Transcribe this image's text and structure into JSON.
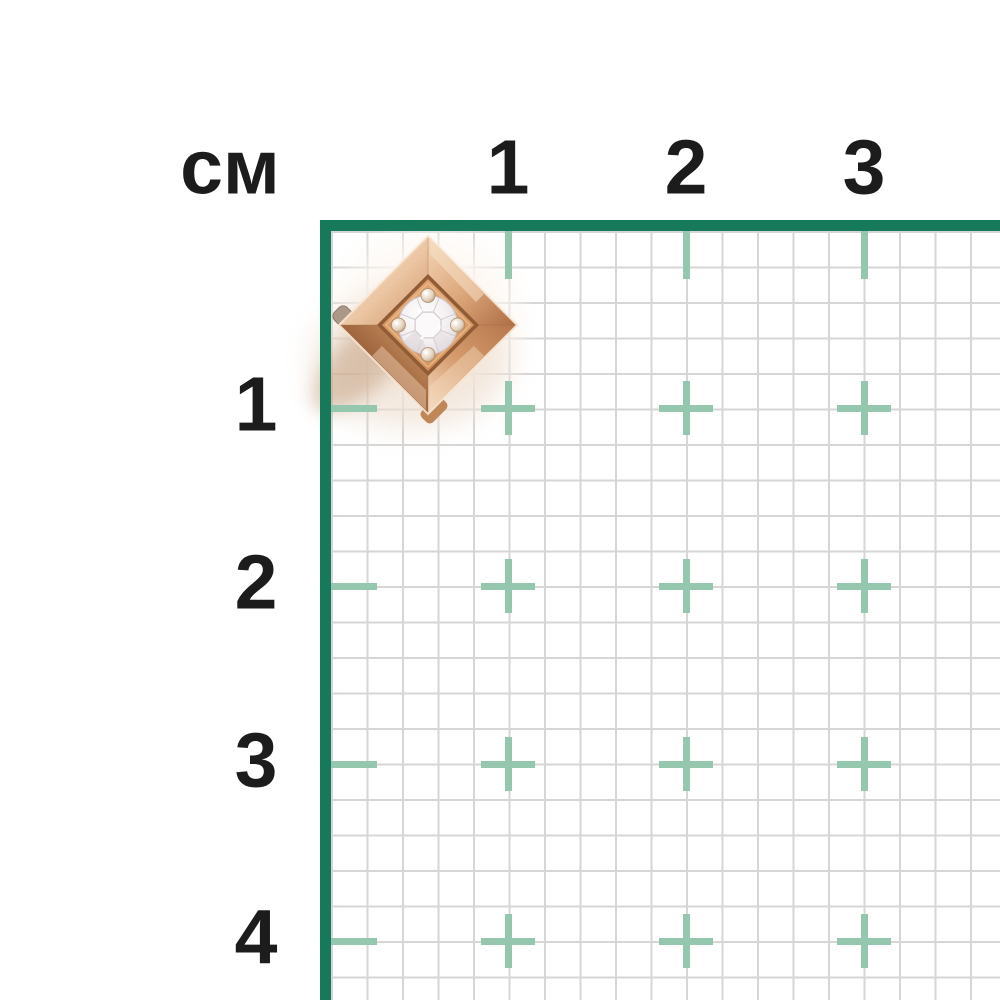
{
  "measurement_scale": {
    "unit_label": "см",
    "x_axis_labels": [
      "1",
      "2",
      "3"
    ],
    "y_axis_labels": [
      "1",
      "2",
      "3",
      "4"
    ]
  },
  "colors": {
    "background": "#ffffff",
    "ruler_border_green": "#15795a",
    "cm_mark_green": "#95c7ae",
    "grid_line_gray": "#d6d6d6",
    "label_text": "#1c1c1c",
    "rose_gold_light": "#f6e0ca",
    "rose_gold_mid": "#cf9161",
    "rose_gold_dark": "#8e5834",
    "diamond_white": "#f8f5f6"
  },
  "product_photo": {
    "alt_label": "rose gold square stud with round diamond",
    "approx_width_cm": "1",
    "approx_height_cm": "1"
  }
}
